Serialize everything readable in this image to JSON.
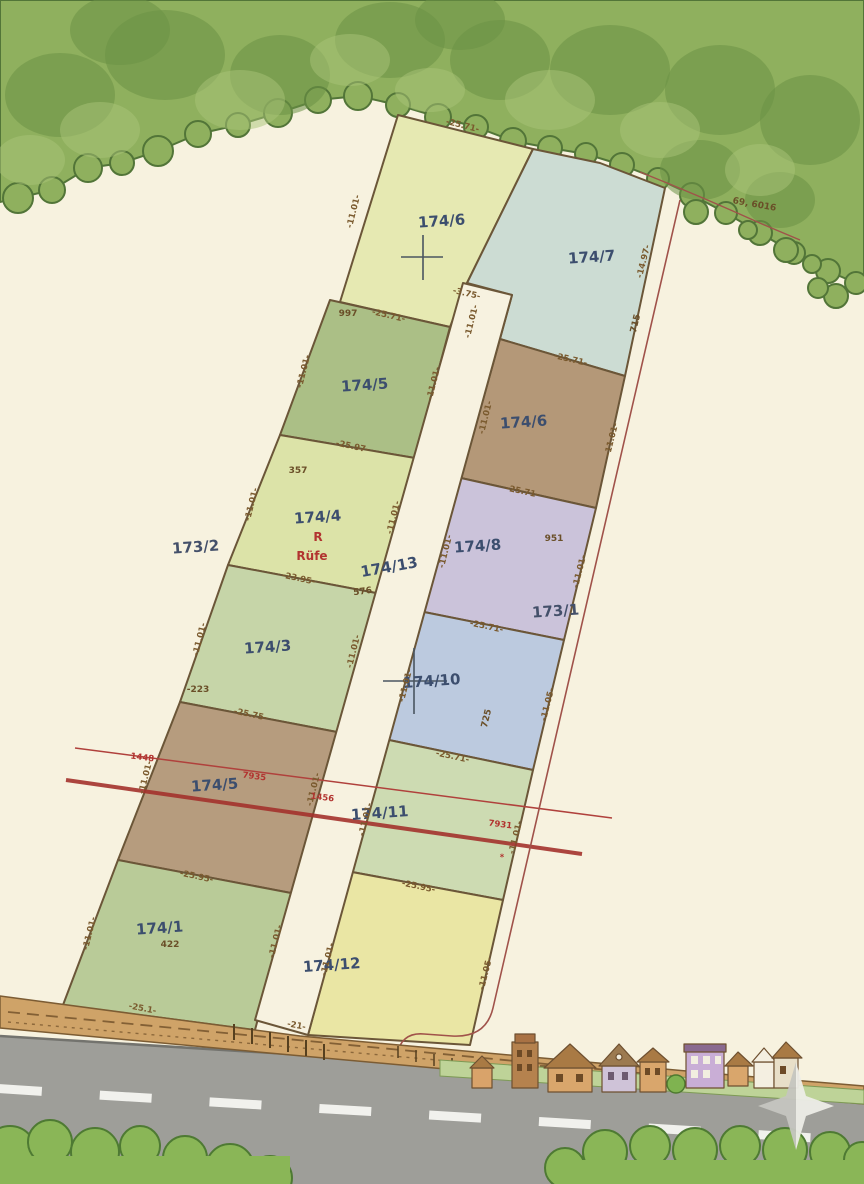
{
  "map_type": "cadastral-parcel-plan",
  "colors": {
    "paper": "#f7f2df",
    "boundary_line": "#6b5638",
    "parcel_label": "#3c4e6e",
    "dimension_text": "#7a5a2e",
    "red_line": "#a3322c",
    "tree_green": "#8fb05e",
    "road_gray": "#9e9e99",
    "track_tan": "#cfa368"
  },
  "parcels": [
    {
      "label": "174/6",
      "fill": "#e6e9b2"
    },
    {
      "label": "174/7",
      "fill": "#ccdcd3"
    },
    {
      "label": "174/5",
      "fill": "#abbf86"
    },
    {
      "label": "174/6",
      "fill": "#b49878"
    },
    {
      "label": "174/4",
      "fill": "#dce3a8"
    },
    {
      "label": "174/8",
      "fill": "#cbc3da"
    },
    {
      "label": "174/3",
      "fill": "#c6d5a8"
    },
    {
      "label": "174/10",
      "fill": "#bccadf"
    },
    {
      "label": "174/5",
      "fill": "#b69c7e"
    },
    {
      "label": "174/11",
      "fill": "#cddbb2"
    },
    {
      "label": "174/1",
      "fill": "#b9cb98"
    },
    {
      "label": "174/12",
      "fill": "#eae6a4"
    },
    {
      "label": "174/13",
      "fill": "#f7f2e0"
    }
  ],
  "neighbors": [
    {
      "label": "173/2"
    },
    {
      "label": "173/1"
    }
  ],
  "annotations": {
    "dimensions": [
      {
        "t": "-25.71-",
        "x": 462,
        "y": 128,
        "r": 14
      },
      {
        "t": "-25.71-",
        "x": 388,
        "y": 318,
        "r": 13
      },
      {
        "t": "-3.75-",
        "x": 466,
        "y": 296,
        "r": 13
      },
      {
        "t": "-25.97-",
        "x": 352,
        "y": 449,
        "r": 12
      },
      {
        "t": "-23.95-",
        "x": 298,
        "y": 581,
        "r": 12
      },
      {
        "t": "-25.75-",
        "x": 250,
        "y": 717,
        "r": 12
      },
      {
        "t": "-25.95-",
        "x": 196,
        "y": 879,
        "r": 12
      },
      {
        "t": "-25.1-",
        "x": 142,
        "y": 1011,
        "r": 11
      },
      {
        "t": "-25.71-",
        "x": 570,
        "y": 362,
        "r": 13
      },
      {
        "t": "-25.71-",
        "x": 522,
        "y": 494,
        "r": 12
      },
      {
        "t": "-25.71-",
        "x": 486,
        "y": 629,
        "r": 12
      },
      {
        "t": "-25.71-",
        "x": 452,
        "y": 759,
        "r": 12
      },
      {
        "t": "-25.95-",
        "x": 418,
        "y": 889,
        "r": 12
      },
      {
        "t": "-21-",
        "x": 296,
        "y": 1028,
        "r": 11
      },
      {
        "t": "-11.01-",
        "x": 356,
        "y": 212,
        "r": -76
      },
      {
        "t": "-11.01-",
        "x": 306,
        "y": 372,
        "r": -76
      },
      {
        "t": "-11.01-",
        "x": 254,
        "y": 505,
        "r": -76
      },
      {
        "t": "-11.01-",
        "x": 202,
        "y": 640,
        "r": -76
      },
      {
        "t": "-11.01-",
        "x": 148,
        "y": 778,
        "r": -76
      },
      {
        "t": "-11.01-",
        "x": 92,
        "y": 934,
        "r": -76
      },
      {
        "t": "-11.01-",
        "x": 436,
        "y": 384,
        "r": -76
      },
      {
        "t": "-11.01-",
        "x": 396,
        "y": 518,
        "r": -76
      },
      {
        "t": "-11.01-",
        "x": 356,
        "y": 652,
        "r": -76
      },
      {
        "t": "-11.01-",
        "x": 316,
        "y": 790,
        "r": -76
      },
      {
        "t": "-11.01-",
        "x": 278,
        "y": 942,
        "r": -76
      },
      {
        "t": "-11.01-",
        "x": 488,
        "y": 418,
        "r": -76
      },
      {
        "t": "-11.01-",
        "x": 448,
        "y": 552,
        "r": -76
      },
      {
        "t": "-11.01-",
        "x": 408,
        "y": 686,
        "r": -76
      },
      {
        "t": "-11.01-",
        "x": 368,
        "y": 820,
        "r": -76
      },
      {
        "t": "-11.01-",
        "x": 330,
        "y": 960,
        "r": -76
      },
      {
        "t": "-14.97-",
        "x": 646,
        "y": 262,
        "r": -76
      },
      {
        "t": "-11.01-",
        "x": 614,
        "y": 440,
        "r": -76
      },
      {
        "t": "-11.01-",
        "x": 582,
        "y": 572,
        "r": -76
      },
      {
        "t": "-11.05-",
        "x": 550,
        "y": 705,
        "r": -76
      },
      {
        "t": "-11.01-",
        "x": 518,
        "y": 838,
        "r": -76
      },
      {
        "t": "-11.05-",
        "x": 488,
        "y": 974,
        "r": -76
      },
      {
        "t": "-11.01-",
        "x": 474,
        "y": 322,
        "r": -76
      }
    ],
    "point_numbers": [
      {
        "t": "997",
        "x": 348,
        "y": 316
      },
      {
        "t": "357",
        "x": 298,
        "y": 473
      },
      {
        "t": "-223",
        "x": 198,
        "y": 692
      },
      {
        "t": "422",
        "x": 170,
        "y": 947
      },
      {
        "t": "576",
        "x": 363,
        "y": 594,
        "r": -8
      },
      {
        "t": "715",
        "x": 638,
        "y": 324,
        "r": -76
      },
      {
        "t": "951",
        "x": 554,
        "y": 541
      },
      {
        "t": "725",
        "x": 489,
        "y": 719,
        "r": -76
      },
      {
        "t": "69, 6016",
        "x": 754,
        "y": 207,
        "r": 10
      }
    ],
    "red_texts": [
      {
        "t": "1448",
        "x": 142,
        "y": 760,
        "r": 7
      },
      {
        "t": "7935",
        "x": 254,
        "y": 779,
        "r": 7
      },
      {
        "t": "1456",
        "x": 322,
        "y": 800,
        "r": 7
      },
      {
        "t": "7931",
        "x": 500,
        "y": 827,
        "r": 7
      },
      {
        "t": "*",
        "x": 502,
        "y": 860,
        "r": 0
      },
      {
        "t": "R",
        "x": 318,
        "y": 541,
        "r": 0,
        "c": "lg"
      },
      {
        "t": "Rüfe",
        "x": 312,
        "y": 560,
        "r": 0,
        "c": "lg"
      }
    ]
  }
}
